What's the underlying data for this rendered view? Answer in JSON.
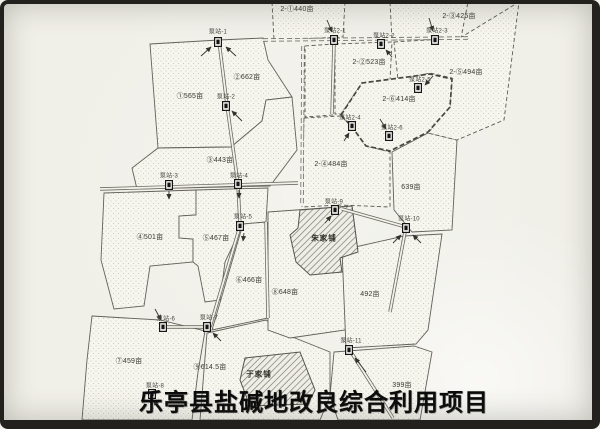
{
  "title": "乐亭县盐碱地改良综合利用项目",
  "parcels": [
    {
      "label": "①565亩"
    },
    {
      "label": "②662亩"
    },
    {
      "label": "③443亩"
    },
    {
      "label": "④501亩"
    },
    {
      "label": "⑤467亩"
    },
    {
      "label": "⑥466亩"
    },
    {
      "label": "⑦459亩"
    },
    {
      "label": "⑧648亩"
    },
    {
      "label": "⑨614.5亩"
    },
    {
      "label": "639亩"
    },
    {
      "label": "492亩"
    },
    {
      "label": "399亩"
    },
    {
      "label": "2-①440亩"
    },
    {
      "label": "2-②523亩"
    },
    {
      "label": "2-③425亩"
    },
    {
      "label": "2-④484亩"
    },
    {
      "label": "2-⑤494亩"
    },
    {
      "label": "2-⑥414亩"
    }
  ],
  "pump_stations": [
    {
      "label": "泵站-1"
    },
    {
      "label": "泵站-2"
    },
    {
      "label": "泵站-3"
    },
    {
      "label": "泵站-4"
    },
    {
      "label": "泵站-5"
    },
    {
      "label": "泵站-6"
    },
    {
      "label": "泵站-7"
    },
    {
      "label": "泵站-8"
    },
    {
      "label": "泵站-9"
    },
    {
      "label": "泵站-10"
    },
    {
      "label": "泵站-11"
    },
    {
      "label": "泵站2-1"
    },
    {
      "label": "泵站2-2"
    },
    {
      "label": "泵站2-3"
    },
    {
      "label": "泵站2-4"
    },
    {
      "label": "泵站2-5"
    },
    {
      "label": "泵站2-6"
    }
  ],
  "villages": [
    {
      "name": "朱家铺"
    },
    {
      "name": "于家铺"
    }
  ],
  "colors": {
    "paper": "#f0efe8",
    "line": "#62615a",
    "title_text": "#0c0c0c",
    "frame": "#22211d"
  }
}
